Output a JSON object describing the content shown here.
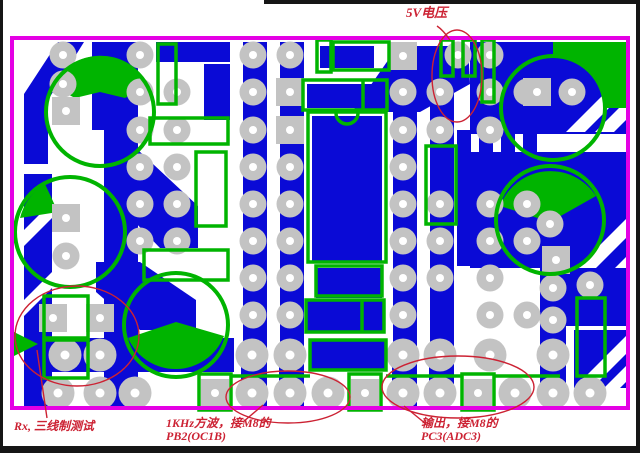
{
  "figure": {
    "kind": "pcb-copper-layout",
    "annotations": {
      "top": {
        "label": "5V电压"
      },
      "bottom_left": {
        "label": "Rx, 三线制测试"
      },
      "bottom_center": {
        "line1": "1KHz方波，接M8的",
        "line2": "PB2(OC1B)"
      },
      "bottom_right": {
        "line1": "输出，接M8的",
        "line2": "PC3(ADC3)"
      }
    }
  },
  "colors": {
    "background": "#ffffff",
    "copper": "#0a0ad6",
    "pad": "#c3c3c3",
    "pad_hole": "#ffffff",
    "silkscreen": "#00b400",
    "board_border": "#e400e4",
    "annotation": "#cc2233",
    "frame": "#161616"
  }
}
